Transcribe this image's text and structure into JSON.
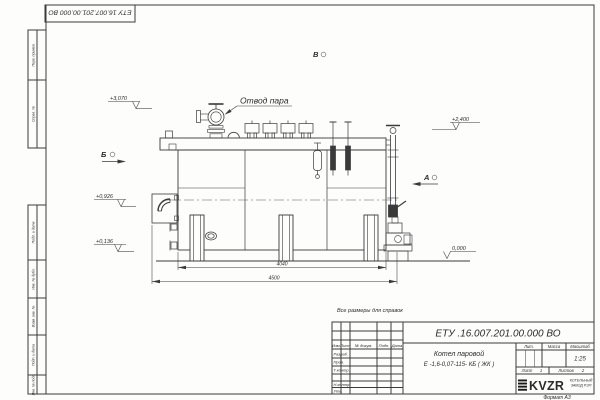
{
  "colors": {
    "ink": "#3a3a3a",
    "paper": "#fdfdfc"
  },
  "stamp_top": {
    "designation": "ЕТУ 16.007.201.00.000  ВО"
  },
  "margin": {
    "col1": "Перв. примен.",
    "col2": "Справ. №",
    "col3": "Подп. и дата",
    "col4": "Инв. № дубл.",
    "col5": "Взам. инв. №",
    "col6": "Подп. и дата",
    "col7": "Инв. № подл."
  },
  "drawing": {
    "callout_steam_outlet": "Отвод пара",
    "view_a": "А",
    "view_b": "Б",
    "view_v": "В",
    "elev_top": "+3,070",
    "elev_drum": "+2,400",
    "elev_burner": "+0,926",
    "elev_low": "+0,136",
    "elev_zero": "0,000",
    "dim_inner": "4040",
    "dim_outer": "4500",
    "ref_note": "Все размеры для справок"
  },
  "title_block": {
    "designation": "ЕТУ .16.007.201.00.000  ВО",
    "name_line1": "Котел паровой",
    "name_line2": "Е -1,6-0,07-115- КБ ( ЖК )",
    "cols": {
      "izm": "Изм.",
      "list": "Лист",
      "n_doc": "№ докум.",
      "podp": "Подп.",
      "data": "Дата"
    },
    "rows": {
      "razrab": "Разраб.",
      "prov": "Пров.",
      "t_contr": "Т.контр.",
      "n_contr": "Н.контр.",
      "utv": "Утв."
    },
    "lit_label": "Лит.",
    "massa_label": "Масса",
    "scale_label": "Масштаб",
    "scale_value": "1:25",
    "sheet_label": "Лист",
    "sheet_num": "1",
    "sheets_label": "Листов",
    "sheets_num": "2",
    "logo_text": "KVZR",
    "company_line1": "КОТЕЛЬНЫЙ",
    "company_line2": "ЗАВОД РЭП",
    "format_label": "Формат А3"
  }
}
